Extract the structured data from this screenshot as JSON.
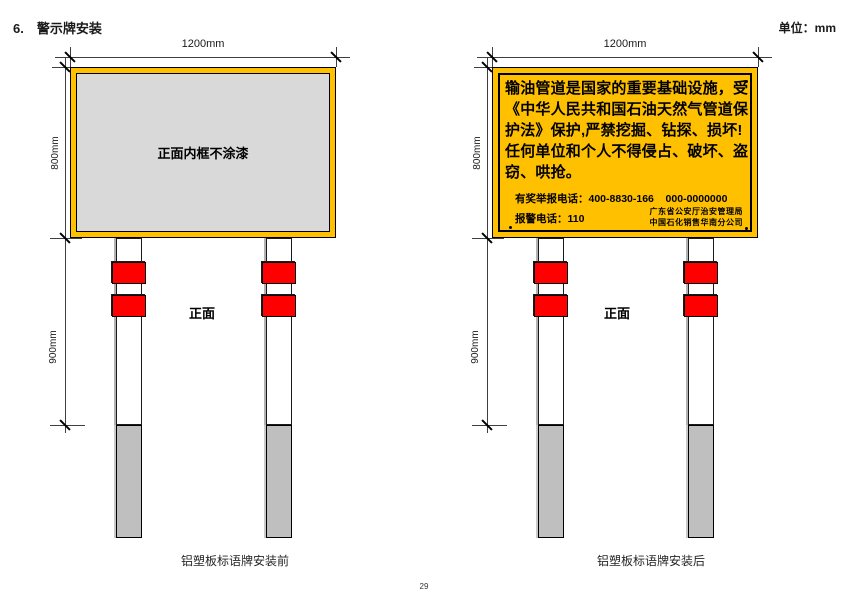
{
  "page": {
    "section_number": "6.",
    "section_title": "警示牌安装",
    "unit_label": "单位：mm",
    "page_number": "29"
  },
  "dim_labels": {
    "width": "1200mm",
    "height": "800mm",
    "post": "900mm"
  },
  "before_diagram": {
    "panel_note": "正面内框不涂漆",
    "front_label": "正面",
    "caption": "铝塑板标语牌安装前"
  },
  "after_diagram": {
    "warning_lines": [
      "输油管道是国家的重要基础设施，受",
      "《中华人民共和国石油天然气管道保",
      "护法》保护,严禁挖掘、钻探、损坏!",
      "任何单位和个人不得侵占、破坏、盗",
      "窃、哄抢。"
    ],
    "hotline": "有奖举报电话：400-8830-166    000-0000000",
    "police": "报警电话：110",
    "org_line1": "广东省公安厅治安管理局",
    "org_line2": "中国石化销售华南分公司",
    "front_label": "正面",
    "caption": "铝塑板标语牌安装后"
  },
  "colors": {
    "sign_yellow": "#FFC000",
    "panel_gray": "#D9D9D9",
    "band_red": "#FE0000",
    "underground_gray": "#BFBFBF",
    "line": "#3F3F3F"
  }
}
